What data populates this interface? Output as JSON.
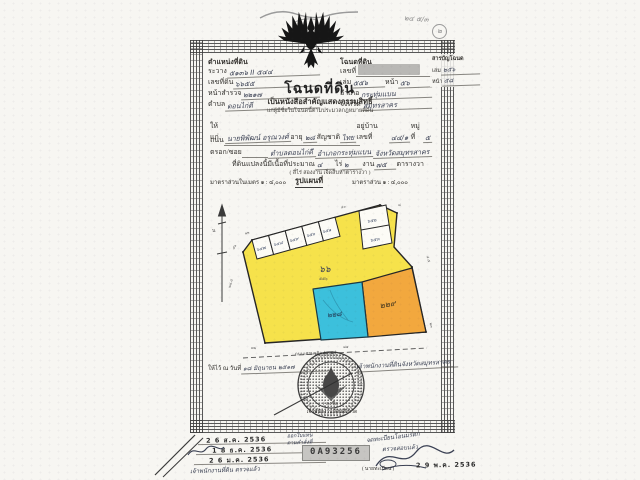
{
  "annotations": {
    "top_right_note": "๒๔ ๕/๓",
    "top_right_circled": "๒"
  },
  "header": {
    "left": {
      "title": "ตำแหน่งที่ดิน",
      "fields": [
        {
          "label": "ระวาง",
          "value": "๕๑๓๖ II ๕๔๔"
        },
        {
          "label": "เลขที่ดิน",
          "value": "๖๖๕๕"
        },
        {
          "label": "หน้าสำรวจ",
          "value": "๒๒๑๗"
        },
        {
          "label": "ตำบล",
          "value": "ดอนไก่ดี"
        }
      ]
    },
    "center": {
      "title": "โฉนดที่ดิน",
      "subtitle": "เป็นหนังสือสำคัญแสดงกรรมสิทธิ์",
      "subtitle2": "แก่ผู้มีชื่อในโฉนดนี้ตามประมวลกฎหมายที่ดิน"
    },
    "right": {
      "title": "โฉนดที่ดิน",
      "no_label": "เลขที่",
      "vol_label": "เล่ม",
      "vol_value": "๕๕๖",
      "page_label": "หน้า",
      "page_value": "๕๖",
      "amphoe_label": "อำเภอ",
      "amphoe_value": "กระทุ่มแบน",
      "province_label": "จังหวัด",
      "province_value": "สมุทรสาคร"
    },
    "index": {
      "title": "สารบัญโฉนด",
      "vol_label": "เล่ม",
      "vol_value": "๒๕๖",
      "page_label": "หน้า",
      "page_value": "๕๘"
    }
  },
  "owner": {
    "grant_label": "ให้แก่",
    "name": "นายพิพัฒน์ อรุณวงศ์",
    "age_label": "อายุ",
    "age": "๒๘",
    "nationality_label": "สัญชาติ",
    "nationality": "ไทย",
    "address_label": "อยู่บ้านเลขที่",
    "address": "๔๔/๑",
    "moo_label": "หมู่ที่",
    "moo": "๕",
    "road_label": "ถนน",
    "soi_label": "ตรอก/ซอย",
    "tambon": "ตำบลดอนไก่ดี",
    "amphoe": "อำเภอกระทุ่มแบน",
    "province": "จังหวัดสมุทรสาคร",
    "area_label": "ที่ดินแปลงนี้มีเนื้อที่ประมาณ",
    "rai": "๔",
    "rai_label": "ไร่",
    "ngan": "๒",
    "ngan_label": "งาน",
    "wa": "๗๕",
    "wa_label": "ตารางวา",
    "area_words": "( สี่ไร่ สองงาน เจ็ดสิบห้าตารางวา )"
  },
  "map": {
    "scale_left": "มาตราส่วนในเมตร ๑ : ๔,๐๐๐",
    "title": "รูปแผนที่",
    "scale_right": "มาตราส่วน ๑ : ๔,๐๐๐",
    "main_parcel": "๖๖",
    "main_parcel_sub": "๕๕๖",
    "blue_parcel": "๒๒๘",
    "orange_parcel": "๒๒๙",
    "small_parcels": [
      "๖๔๗",
      "๖๔๘",
      "๖๔๙",
      "๖๕๐",
      "๖๕๑"
    ],
    "right_parcels": [
      "๖๕๒",
      "๖๕๓"
    ],
    "road": "ถนนเศรษฐกิจ ( ๓๕ )",
    "north_label": "น",
    "ticks": [
      "๔๖",
      "๑๒",
      "๔๐",
      "๘",
      "๔.๕",
      "๒๓",
      "๘๕",
      "๗๒",
      "๒๘.๕"
    ]
  },
  "issue": {
    "date_label": "ให้ไว้ ณ วันที่",
    "date_value": "๑๘ มิถุนายน ๒๕๑๗",
    "official": "เจ้าพนักงานที่ดินจังหวัดสมุทรสาคร",
    "seal_caption1": "( ลงชื่อ )",
    "seal_caption2": "เจ้าพนักงานที่ดินจังหวัด"
  },
  "footer": {
    "left_stamps": [
      "2 6 ส.ค. 2536",
      "1 8 ธ.ค. 2536",
      "2 6 ม.ค. 2536"
    ],
    "left_note": "เจ้าพนักงานที่ดิน ตรวจแล้ว",
    "center_line1": "ออกใบแทน",
    "center_line2": "ตามคำสั่งที่",
    "serial": "0A93256",
    "right_note1": "จดทะเบียนโอนมรดก",
    "right_note2": "ตรวจสอบแล้ว",
    "right_stamp": "2 9 พ.ค. 2536",
    "right_caption": "( นายทะเบียน )"
  }
}
